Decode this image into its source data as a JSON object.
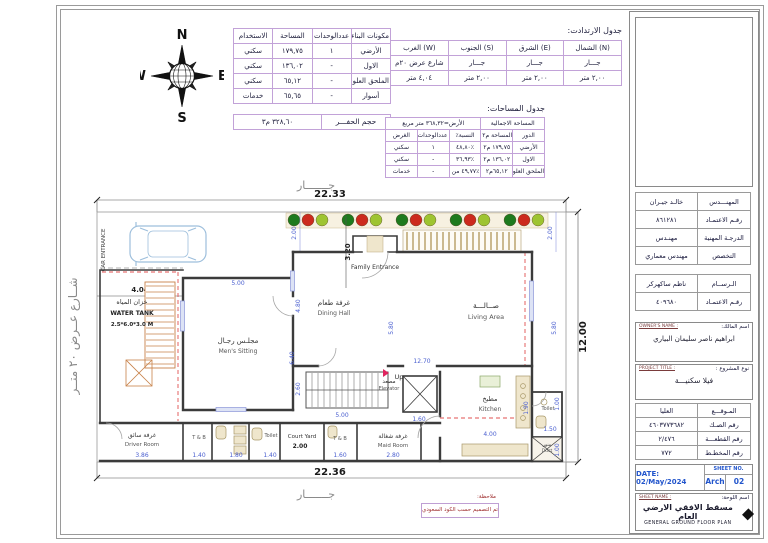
{
  "colors": {
    "table_border": "#c2a2d8",
    "dim_blue": "#4a5fd0",
    "wall": "#3b3b3b",
    "red_dash": "#e05050",
    "hatch_orange": "#c8824a",
    "tree_dark": "#1e7a1e",
    "tree_red": "#cc2a1e",
    "tree_light": "#9ec431",
    "car_blue": "#9ebfdc",
    "note_red": "#a03030",
    "date_blue": "#2255cc"
  },
  "compass": {
    "n": "N",
    "s": "S",
    "e": "E",
    "w": "W"
  },
  "components_table": {
    "headers": [
      "مكونات البناء",
      "عددالوحدات",
      "المساحة",
      "الاستخدام"
    ],
    "rows": [
      [
        "الأرضي",
        "١",
        "١٧٩,٧٥",
        "سكني"
      ],
      [
        "الاول",
        "-",
        "١٣٦,٠٢",
        "سكني"
      ],
      [
        "الملحق العلوي",
        "-",
        "٦٥,١٢",
        "سكني"
      ],
      [
        "أسوار",
        "-",
        "٦٥,٦٥",
        "خدمات"
      ]
    ]
  },
  "excavation": {
    "label": "حجم الحفـــر",
    "value": "٣٢٨,٦٠ م٣"
  },
  "setbacks_table": {
    "title": "جدول الارتدادت:",
    "headers": [
      "(N) الشمال",
      "(E) الشرق",
      "(S) الجنوب",
      "(W) الغرب"
    ],
    "rows": [
      [
        "جـــار",
        "جـــار",
        "جـــار",
        "شارع عرض ٢٠م"
      ],
      [
        "٢,٠٠ متر",
        "٢,٠٠ متر",
        "٢,٠٠ متر",
        "٤,٠٤ متر"
      ]
    ]
  },
  "areas_table": {
    "title": "جدول المساحات:",
    "total_label": "المساحة الاجمالية",
    "total_value": "الأرض=٣٦٨,٣٢ متر مربع",
    "headers": [
      "الدور",
      "المساحة م٢",
      "النسبة٪",
      "عددالوحدات",
      "الغرض"
    ],
    "rows": [
      [
        "الأرضي",
        "١٧٩,٧٥ م٢",
        "٪٤٨,٨٠",
        "١",
        "سكني"
      ],
      [
        "الاول",
        "١٣٦,٠٢ م٢",
        "٪٣٦,٩٣",
        "-",
        "سكني"
      ],
      [
        "الملحق العلوي",
        "٦٥,١٢م٢",
        "٪٤٩,٧٧ من الدورالاول",
        "-",
        "خدمات"
      ]
    ]
  },
  "title_block": {
    "rows1": [
      {
        "label": "المهنـــدس",
        "value": "خالـد جيـران"
      },
      {
        "label": "رقـم الاعتمـاد",
        "value": "٨٦١٢٨١"
      },
      {
        "label": "الدرجـة المهنية",
        "value": "مهنـدس"
      },
      {
        "label": "التخصص",
        "value": "مهندس معماري"
      }
    ],
    "rows2": [
      {
        "label": "الـرســام",
        "value": "ناظم ساكهركر"
      },
      {
        "label": "رقـم الاعتمـاد",
        "value": "٤٠٩٦٨٠"
      }
    ],
    "owner": {
      "tag": "OWNER'S NAME :",
      "label": "اسم المالك:",
      "value": "ابراهيم ناصر سليمان البياري"
    },
    "project": {
      "tag": "PROJECT TITLE :",
      "label": "نوع المشروع :",
      "value": "فيلا سكنيـــة"
    },
    "rows3": [
      {
        "label": "المـوقـــع",
        "value": "العليا"
      },
      {
        "label": "رقم الصـك",
        "value": "٤٦٠٣٧٧٣٦٨٢"
      },
      {
        "label": "رقم القطعـــة",
        "value": "٢/٤٧٦"
      },
      {
        "label": "رقم المخطـط",
        "value": "٧٧٢"
      }
    ],
    "date": "DATE: 02/May/2024",
    "sheet_no_label": "SHEET NO.",
    "sheet_no_1": "Arch",
    "sheet_no_2": "02",
    "sheet_name_tag": "SHEET NAME :",
    "sheet_name_label": "اسم اللوحة:",
    "sheet_name_ar": "مسقط الافقي الارضي العام",
    "sheet_name_en": "GENERAL GROUND FLOOR PLAN"
  },
  "note": {
    "label": "ملاحظة:",
    "text": "تم التصميم حسب الكود السعودي"
  },
  "plan": {
    "neighbor_top": "جـــــــار",
    "neighbor_bottom": "جـــــــار",
    "street": "شــارع عــرض ٢٠ متــر",
    "car_entrance": "CAR ENTRANCE",
    "rooms": {
      "water_tank": {
        "ar": "خزان المياه",
        "en": "WATER TANK",
        "size": "2.5*6.0*3.0 M"
      },
      "mens_sitting": {
        "ar": "مجلـس رجـال",
        "en": "Men's Sitting"
      },
      "dining": {
        "ar": "غرفة طعام",
        "en": "Dining Hall"
      },
      "living": {
        "ar": "صــالـــة",
        "en": "Living Area"
      },
      "family_entrance": {
        "en": "Family Entrance"
      },
      "stairs": {
        "en": "Up"
      },
      "elevator": {
        "ar": "مصعد",
        "en": "Elevator"
      },
      "kitchen": {
        "ar": "مطبخ",
        "en": "Kitchen"
      },
      "maid": {
        "ar": "غرفة شغالة",
        "en": "Maid Room"
      },
      "tb2": {
        "en": "T & B"
      },
      "court": {
        "en": "Court Yard"
      },
      "toilet1": {
        "en": "Toilet"
      },
      "tb1": {
        "en": "T & B"
      },
      "driver": {
        "ar": "غرفة سائق",
        "en": "Driver Room"
      },
      "toilet2": {
        "en": "Toilet"
      },
      "duct": {
        "ar": "منور",
        "en": "Duct"
      }
    },
    "dims": {
      "top": "22.33",
      "bottom": "22.36",
      "right": "12.00",
      "st_l": "2.00",
      "st_r": "2.00",
      "garage_h": "3.20",
      "street_set": "4.04",
      "mens_w": "5.00",
      "din1": "4.80",
      "din2": "6.40",
      "liv1": "5.80",
      "liv2": "12.70",
      "liv3": "5.80",
      "stair_h": "2.60",
      "stair_w": "5.00",
      "elev": "1.60",
      "drv": "3.86",
      "tb1": "1.40",
      "wc1": "1.80",
      "wc2": "1.40",
      "court": "2.00",
      "tb2": "1.60",
      "maid": "2.80",
      "kit_w": "4.00",
      "kit_h": "1.90",
      "wc3": "1.50",
      "duct": "1.00",
      "wc4": "1.00"
    },
    "trees": {
      "count": 15,
      "colors": [
        "#1e7a1e",
        "#cc2a1e",
        "#9ec431"
      ]
    }
  }
}
